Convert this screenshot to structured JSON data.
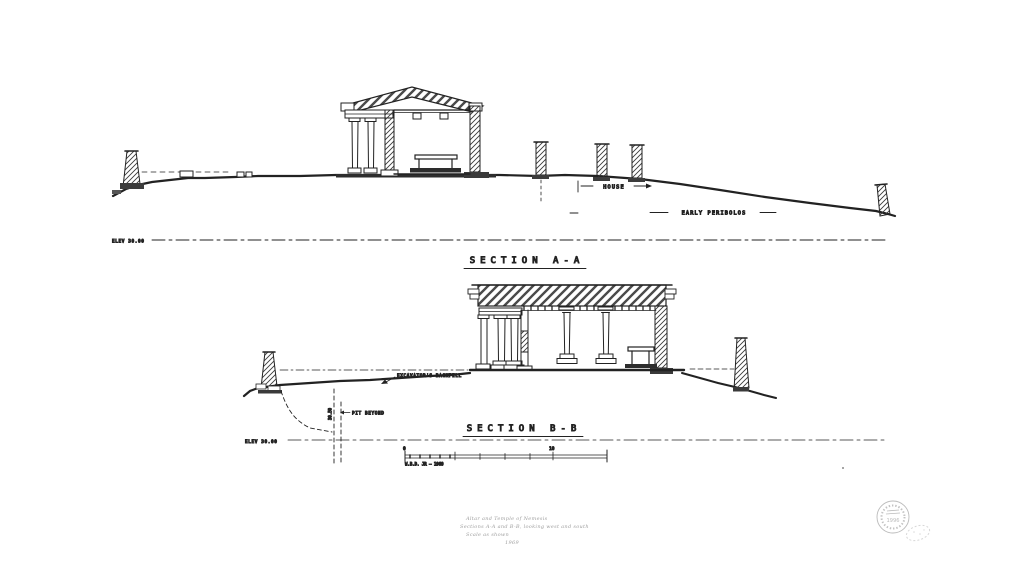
{
  "sheet": {
    "background": "#ffffff",
    "ink": "#222222"
  },
  "section_a": {
    "title": "SECTION A-A",
    "house_label": "HOUSE",
    "peribolos_label": "EARLY PERIBOLOS",
    "elev_label": "ELEV 30.00"
  },
  "section_b": {
    "title": "SECTION B-B",
    "backfill_label": "EXCAVATOR'S BACKFILL",
    "pit_label": "PIT BEYOND",
    "pit_elev_label": "30.50",
    "elev_label": "ELEV 30.00"
  },
  "scale_bar": {
    "start": "0",
    "mid": "10",
    "credit": "W.B.D. JR — 1969"
  },
  "caption": {
    "line1": "Altar and Temple of Nemesis",
    "line2": "Sections A-A and B-B, looking west and south",
    "line3": "Scale as shown",
    "line4": "1969"
  },
  "stamp": {
    "year": "1996"
  }
}
